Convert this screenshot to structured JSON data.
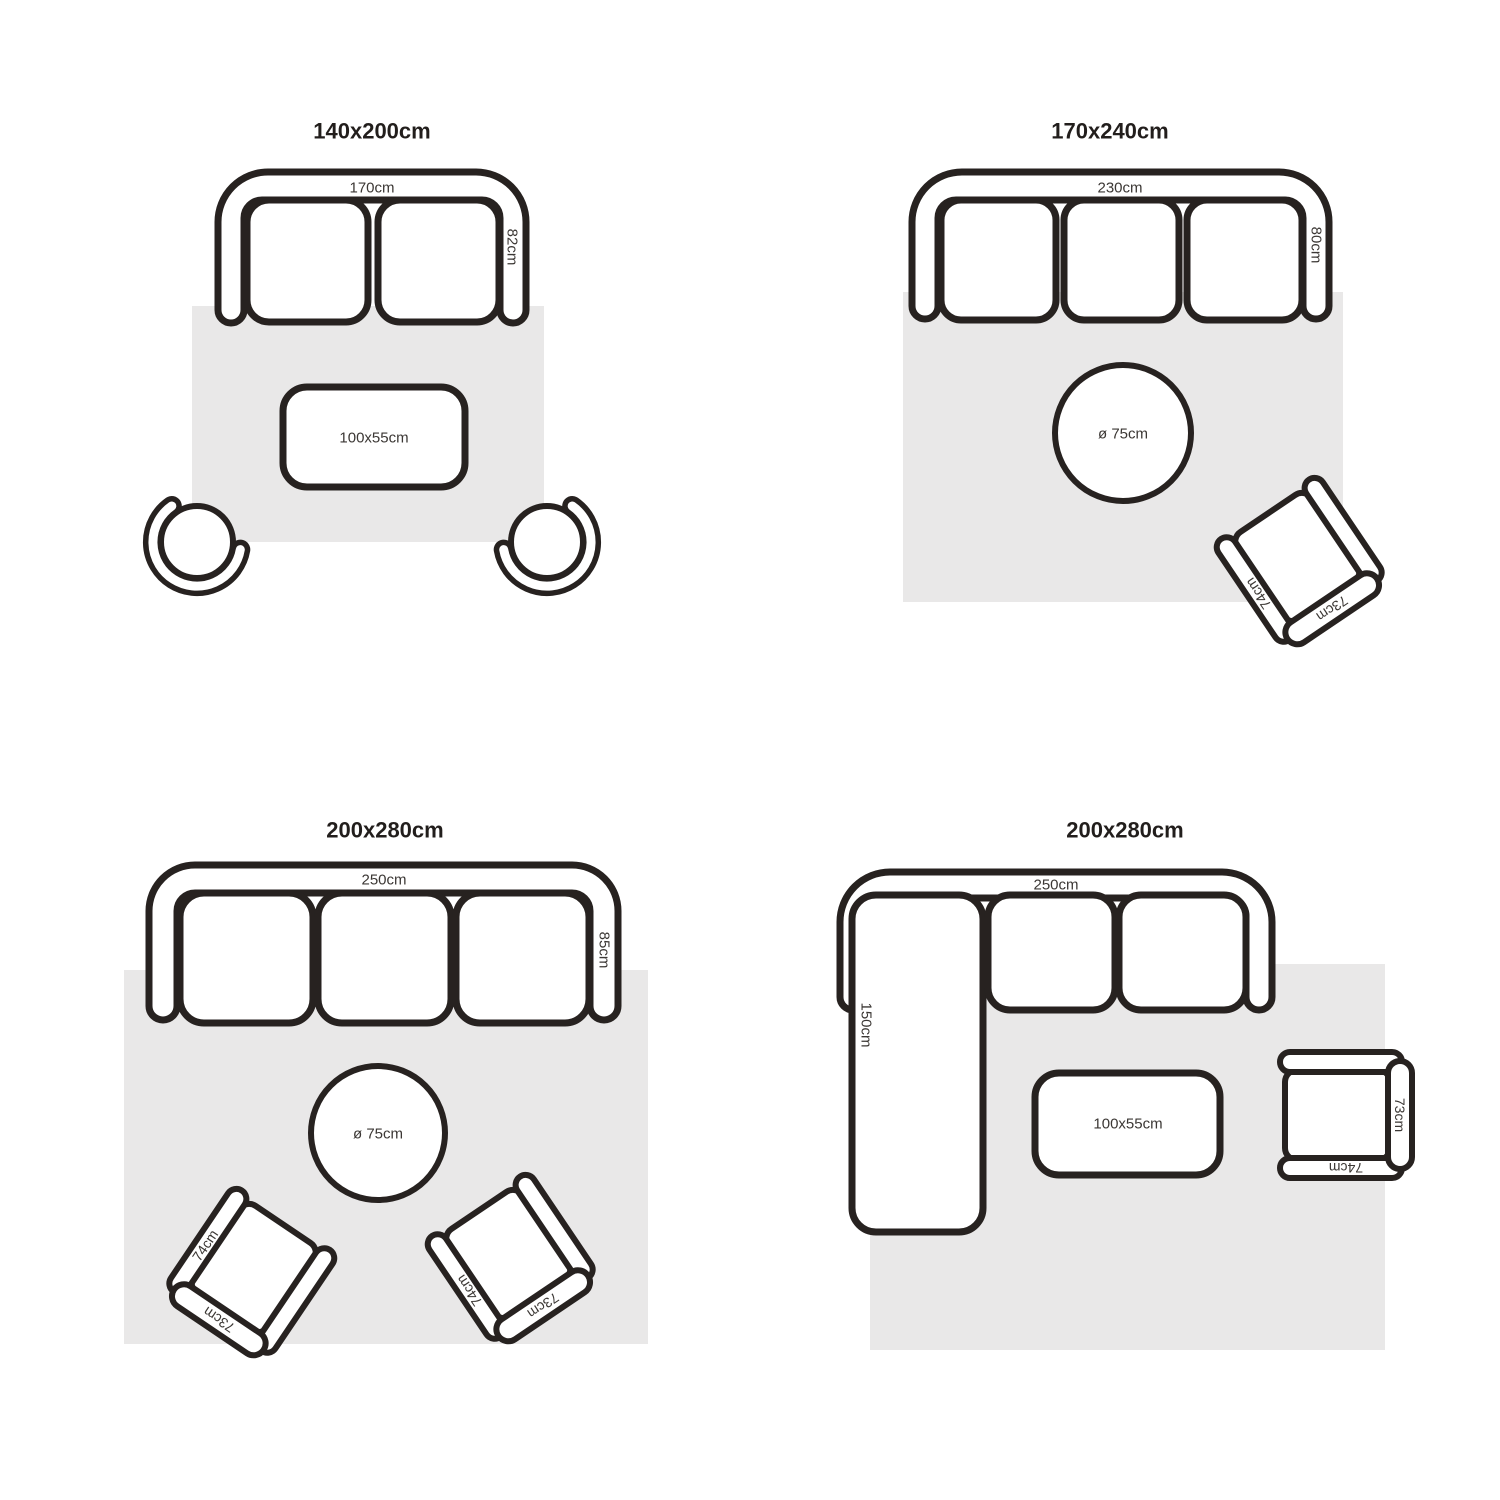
{
  "colors": {
    "background": "#ffffff",
    "outline": "#272220",
    "rug_fill": "#e9e8e8",
    "title_text": "#221e1c",
    "label_text": "#3b3734"
  },
  "quadrants": [
    {
      "title": "140x200cm",
      "sofa": {
        "width": "170cm",
        "depth": "82cm",
        "seats": 2
      },
      "table": {
        "shape": "rectangle",
        "label": "100x55cm"
      },
      "chairs": []
    },
    {
      "title": "170x240cm",
      "sofa": {
        "width": "230cm",
        "depth": "80cm",
        "seats": 3
      },
      "table": {
        "shape": "round",
        "label": "ø 75cm"
      },
      "chairs": [
        {
          "width": "73cm",
          "depth": "74cm"
        }
      ]
    },
    {
      "title": "200x280cm",
      "sofa": {
        "width": "250cm",
        "depth": "85cm",
        "seats": 3
      },
      "table": {
        "shape": "round",
        "label": "ø 75cm"
      },
      "chairs": [
        {
          "width": "73cm",
          "depth": "74cm"
        },
        {
          "width": "73cm",
          "depth": "74cm"
        }
      ]
    },
    {
      "title": "200x280cm",
      "sofa": {
        "width": "250cm",
        "chaise_depth": "150cm",
        "seats": 2
      },
      "table": {
        "shape": "rectangle",
        "label": "100x55cm"
      },
      "chairs": [
        {
          "width": "73cm",
          "depth": "74cm"
        }
      ]
    }
  ]
}
